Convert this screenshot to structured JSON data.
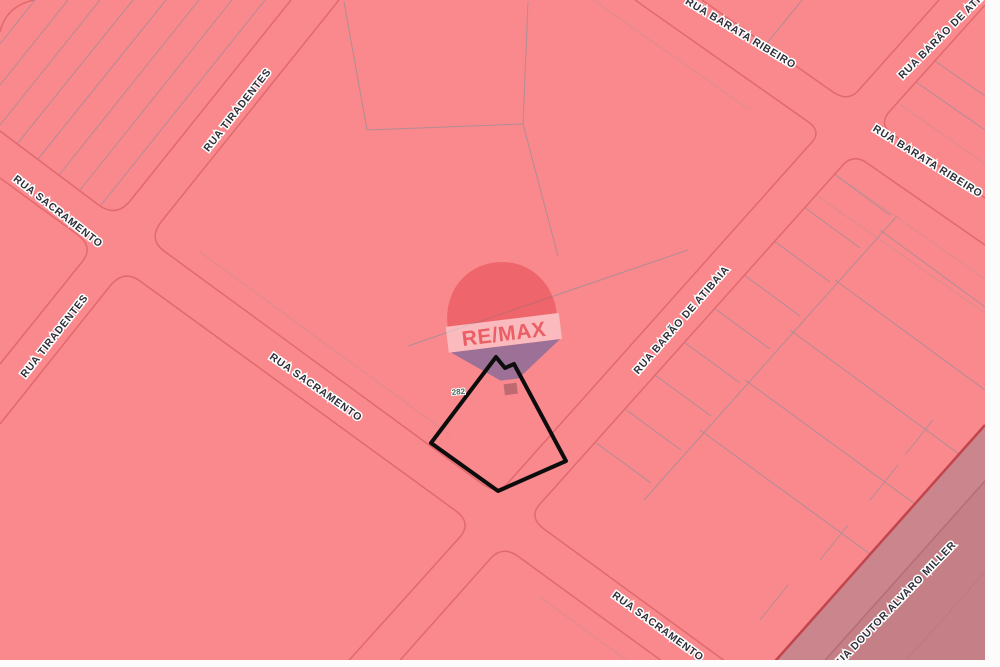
{
  "map": {
    "colors": {
      "background": "#f9898d",
      "road_edge": "#e2696e",
      "road_edge_soft": "#e89094",
      "parcel_line": "#a68d96",
      "parcel_line_red": "#d98d92",
      "corner_band": "#cb858c",
      "corner_band_dark": "#c57f86",
      "corner_boundary": "#c2444d",
      "highlight_outline": "#0d0d0d",
      "margin": "#fcfcfc"
    },
    "labels": [
      {
        "id": "sacramento-top-left",
        "text": "RUA SACRAMENTO"
      },
      {
        "id": "tiradentes-top",
        "text": "RUA TIRADENTES"
      },
      {
        "id": "tiradentes-left",
        "text": "RUA TIRADENTES"
      },
      {
        "id": "sacramento-mid",
        "text": "RUA SACRAMENTO"
      },
      {
        "id": "barata-ribeiro-top",
        "text": "RUA BARATA RIBEIRO"
      },
      {
        "id": "barao-de-atibaia-mid",
        "text": "RUA BARÃO DE ATIBAIA"
      },
      {
        "id": "barao-de-atibaia-corner",
        "text": "RUA BARÃO DE ATIBAIA"
      },
      {
        "id": "barata-ribeiro-right",
        "text": "RUA BARATA RIBEIRO"
      },
      {
        "id": "sacramento-bottom",
        "text": "RUA SACRAMENTO"
      },
      {
        "id": "doutor-alvaro-miller",
        "text": "RUA DOUTOR ALVARO MILLER"
      }
    ],
    "parcel_number": "282",
    "balloon": {
      "brand": "RE/MAX"
    }
  }
}
